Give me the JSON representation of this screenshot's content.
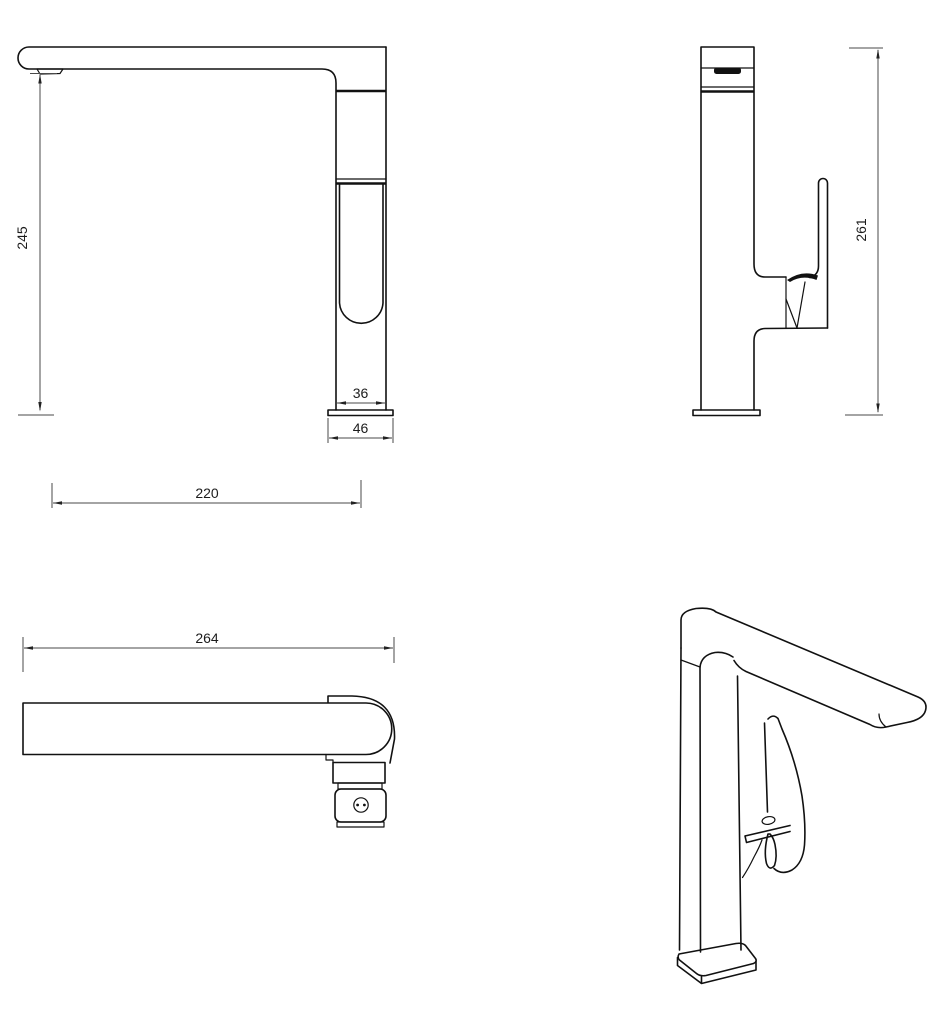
{
  "drawing": {
    "colors": {
      "background": "#ffffff",
      "outline": "#111111",
      "dimension_lines": "#4a4a4a",
      "text": "#1c1c1c"
    },
    "views": {
      "side": {
        "height": "245",
        "body_width": "36",
        "base_width": "46",
        "spout_reach": "220"
      },
      "front": {
        "height": "261"
      },
      "top": {
        "overall_length": "264"
      }
    }
  }
}
